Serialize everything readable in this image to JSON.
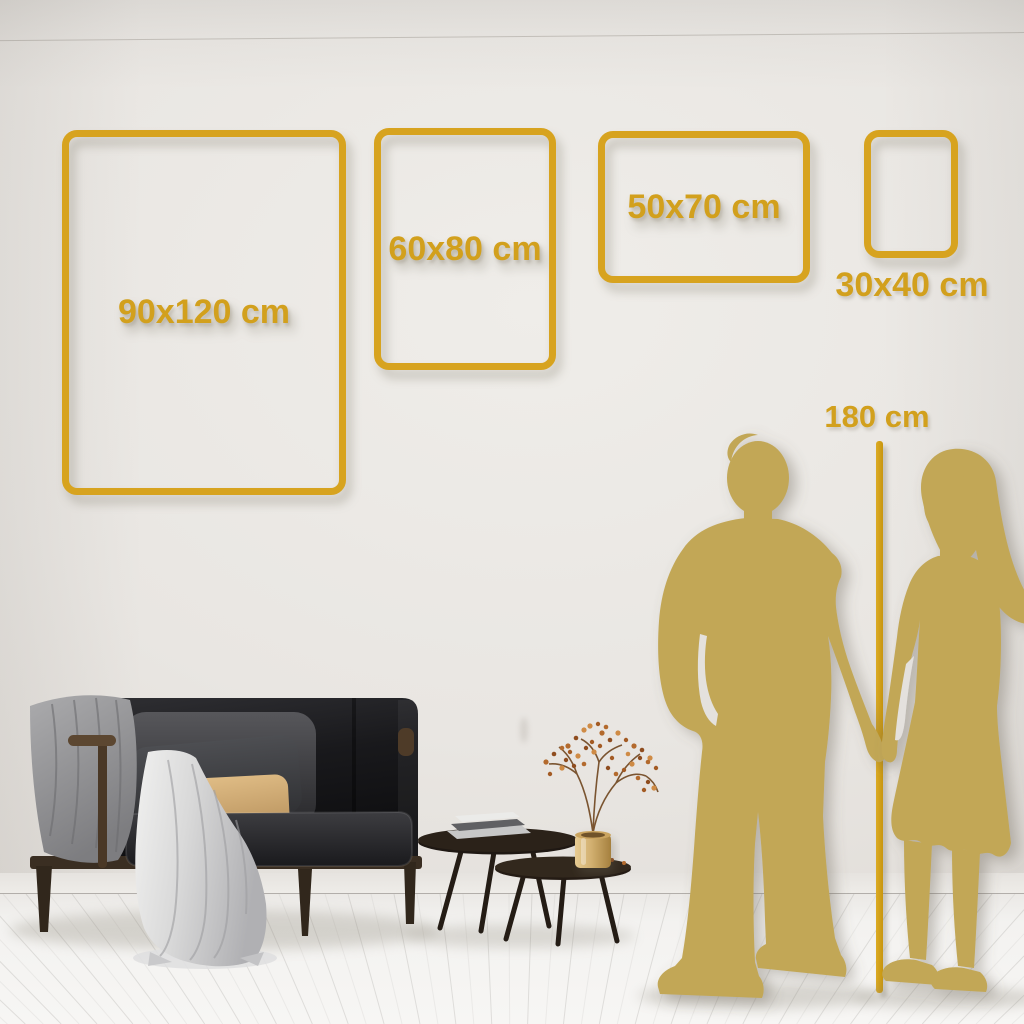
{
  "page": {
    "title": "Wall art size comparison guide"
  },
  "colors": {
    "frame_gold": "#d7a31f",
    "text_gold": "#d2a01d",
    "silhouette_gold": "#c2a757",
    "height_line_gold": "#cc9b13",
    "wall": "#e8e5e1",
    "floor": "#f4f3f1"
  },
  "size_frames": [
    {
      "id": "90x120",
      "label": "90x120 cm",
      "orientation": "portrait"
    },
    {
      "id": "60x80",
      "label": "60x80 cm",
      "orientation": "portrait"
    },
    {
      "id": "50x70",
      "label": "50x70 cm",
      "orientation": "landscape"
    },
    {
      "id": "30x40",
      "label": "30x40 cm",
      "orientation": "portrait"
    }
  ],
  "height_reference": {
    "label": "180 cm"
  },
  "scene": {
    "figures": [
      {
        "name": "man-silhouette"
      },
      {
        "name": "woman-silhouette"
      }
    ],
    "furniture": [
      {
        "name": "sofa"
      },
      {
        "name": "gray-throw-blanket"
      },
      {
        "name": "white-draped-throw"
      },
      {
        "name": "dark-cushion"
      },
      {
        "name": "tan-cushion"
      },
      {
        "name": "nesting-coffee-tables"
      },
      {
        "name": "book-stack"
      },
      {
        "name": "brass-vase"
      },
      {
        "name": "dried-berry-plant"
      }
    ]
  }
}
